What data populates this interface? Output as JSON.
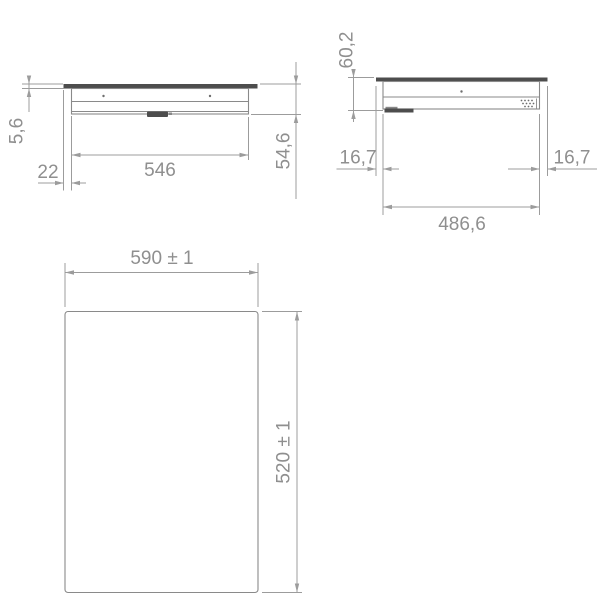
{
  "drawing_type": "installation-dimension-drawing",
  "views": {
    "side": {
      "glass_thickness": "5,6",
      "edge_offset": "22",
      "body_width": "546",
      "body_depth": "54,6"
    },
    "front": {
      "total_height": "60,2",
      "overhang_left": "16,7",
      "overhang_right": "16,7",
      "body_width": "486,6"
    },
    "top": {
      "cutout_width": "590 ± 1",
      "cutout_depth": "520 ± 1"
    }
  },
  "colors": {
    "line": "#9c9c9c",
    "outline": "#8a8a8a",
    "dark_panel": "#4d4d4d",
    "text": "#8f8f8f",
    "background": "#ffffff"
  }
}
